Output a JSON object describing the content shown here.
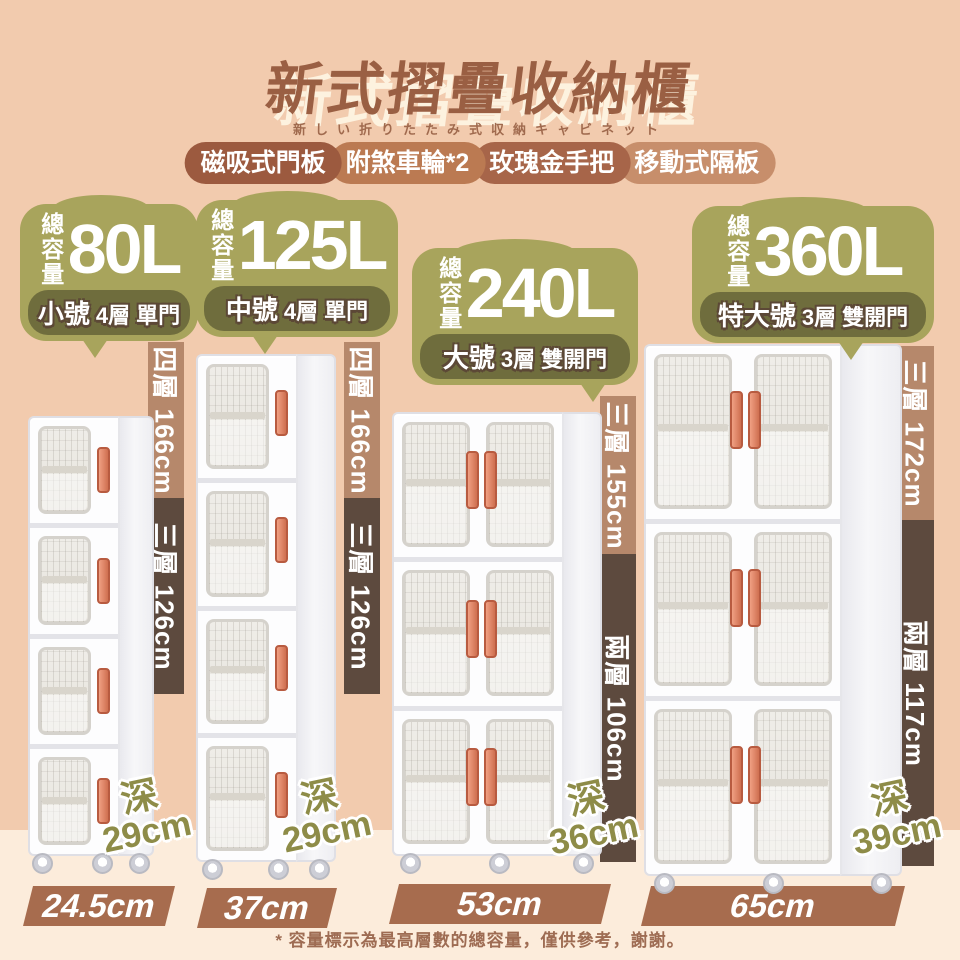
{
  "header": {
    "title": "新式摺疊收納櫃",
    "subtitle_jp": "新しい折りたたみ式収納キャビネット",
    "features": [
      {
        "label": "磁吸式門板",
        "color": "#9c5a3f"
      },
      {
        "label": "附煞車輪*2",
        "color": "#bb7a52"
      },
      {
        "label": "玫瑰金手把",
        "color": "#a76549"
      },
      {
        "label": "移動式隔板",
        "color": "#c78e6b"
      }
    ]
  },
  "products": [
    {
      "capacity": "80L",
      "capacity_label": "總容量",
      "grade": "小號",
      "spec": "4層 單門",
      "height_full": "四層 166cm",
      "height_partial": "三層 126cm",
      "depth_label": "深",
      "depth": "29cm",
      "width": "24.5cm"
    },
    {
      "capacity": "125L",
      "capacity_label": "總容量",
      "grade": "中號",
      "spec": "4層 單門",
      "height_full": "四層 166cm",
      "height_partial": "三層 126cm",
      "depth_label": "深",
      "depth": "29cm",
      "width": "37cm"
    },
    {
      "capacity": "240L",
      "capacity_label": "總容量",
      "grade": "大號",
      "spec": "3層 雙開門",
      "height_full": "三層 155cm",
      "height_partial": "兩層 106cm",
      "depth_label": "深",
      "depth": "36cm",
      "width": "53cm"
    },
    {
      "capacity": "360L",
      "capacity_label": "總容量",
      "grade": "特大號",
      "spec": "3層 雙開門",
      "height_full": "三層 172cm",
      "height_partial": "兩層 117cm",
      "depth_label": "深",
      "depth": "39cm",
      "width": "65cm"
    }
  ],
  "footnote": "* 容量標示為最高層數的總容量，僅供參考，謝謝。",
  "colors": {
    "background_top": "#f2cbae",
    "background_bottom": "#fcecdb",
    "title_brown": "#9a5f43",
    "badge_olive": "#a8a45c",
    "badge_band_olive": "#6f6d3d",
    "bar_light_brown": "#b6886b",
    "bar_dark_brown": "#5d4a3e",
    "width_bar_brown": "#a76c4e",
    "depth_text_olive": "#8e8c48",
    "handle_rose_gold": "#d97b5c"
  }
}
